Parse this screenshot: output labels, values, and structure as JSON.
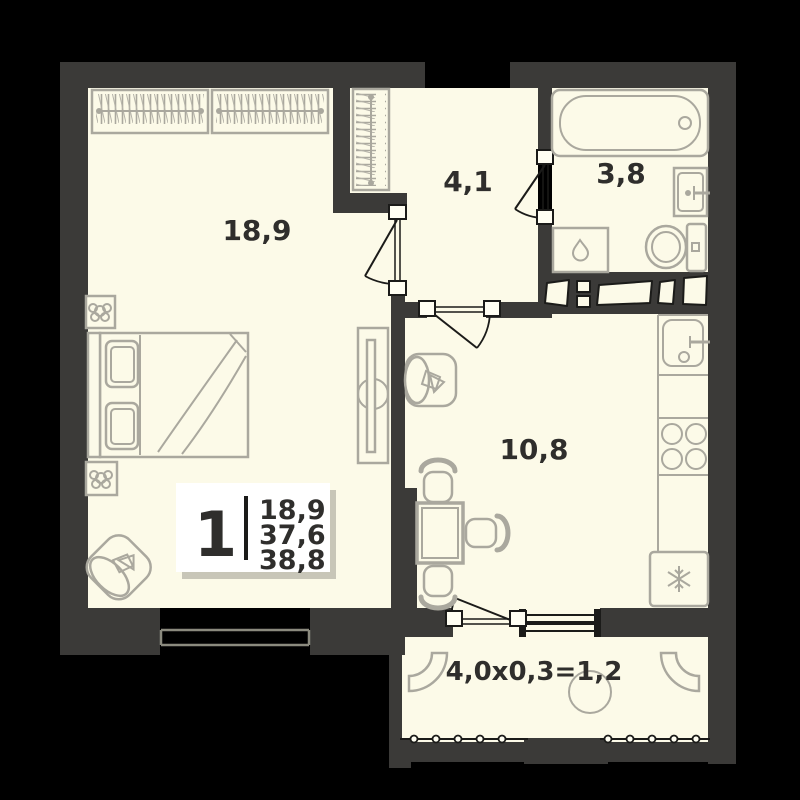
{
  "plan": {
    "rooms": [
      {
        "id": "bedroom",
        "area_label": "18,9"
      },
      {
        "id": "hallway",
        "area_label": "4,1"
      },
      {
        "id": "bathroom",
        "area_label": "3,8"
      },
      {
        "id": "kitchen",
        "area_label": "10,8"
      },
      {
        "id": "balcony",
        "area_label": "4,0x0,3=1,2"
      }
    ],
    "summary_badge": {
      "rooms_count": "1",
      "areas": [
        "18,9",
        "37,6",
        "38,8"
      ]
    }
  },
  "icons": {
    "fridge": "snowflake-icon",
    "washing_machine": "water-drop-icon"
  },
  "colors": {
    "background": "#000000",
    "wall": "#3b3a38",
    "floor": "#fcfae8",
    "furniture_line": "#aaa89e",
    "dark_line": "#1b1b19",
    "label_text": "#2f2e2c",
    "badge_bg": "#ffffff",
    "badge_shadow": "#c8c6b8"
  }
}
